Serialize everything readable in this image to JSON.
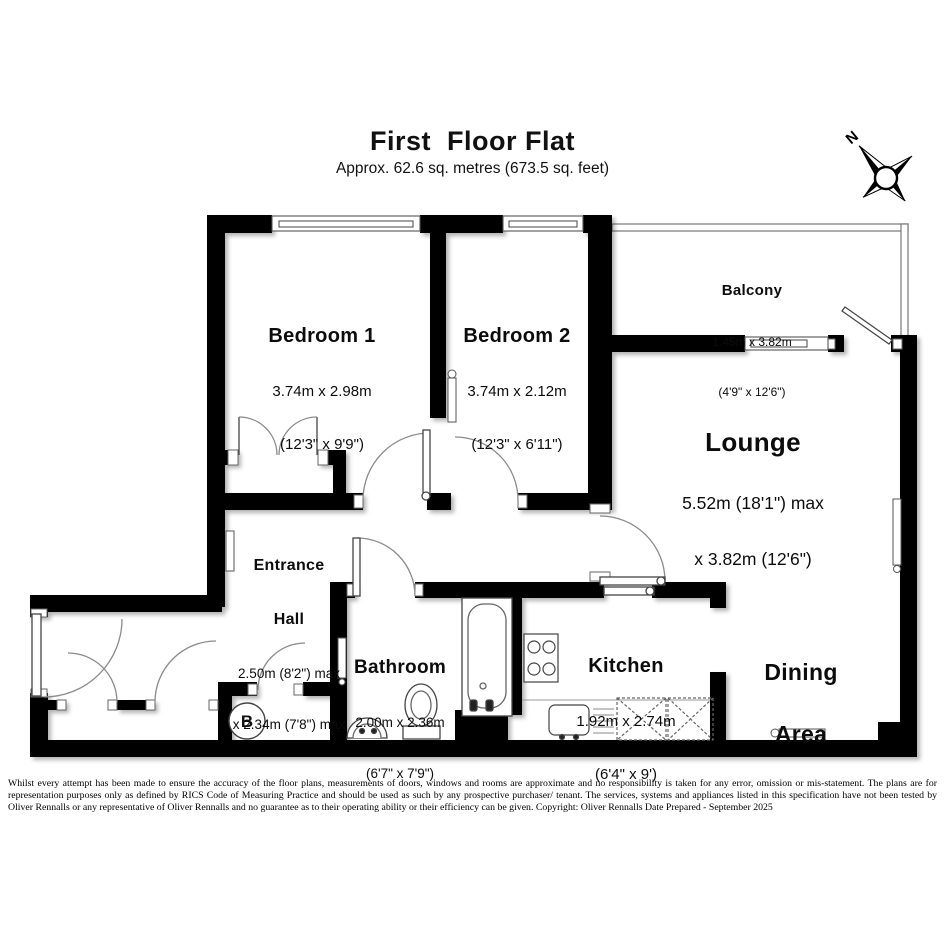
{
  "title": {
    "heading": "First  Floor Flat",
    "subtitle": "Approx. 62.6 sq. metres (673.5 sq. feet)"
  },
  "compass": {
    "north_label": "N"
  },
  "rooms": {
    "bedroom1": {
      "name": "Bedroom 1",
      "dims_metric": "3.74m x 2.98m",
      "dims_imperial": "(12'3\" x 9'9\")"
    },
    "bedroom2": {
      "name": "Bedroom 2",
      "dims_metric": "3.74m x 2.12m",
      "dims_imperial": "(12'3\" x 6'11\")"
    },
    "balcony": {
      "name": "Balcony",
      "dims_metric": "1.45m x 3.82m",
      "dims_imperial": "(4'9\" x 12'6\")"
    },
    "lounge": {
      "name": "Lounge",
      "dims_line1": "5.52m (18'1\") max",
      "dims_line2": "x 3.82m (12'6\")"
    },
    "entrance_hall": {
      "name_line1": "Entrance",
      "name_line2": "Hall",
      "dims_line1": "2.50m (8'2\") max",
      "dims_line2": "x 2.34m (7'8\") max"
    },
    "bathroom": {
      "name": "Bathroom",
      "dims_metric": "2.00m x 2.36m",
      "dims_imperial": "(6'7\" x 7'9\")"
    },
    "kitchen": {
      "name": "Kitchen",
      "dims_metric": "1.92m x 2.74m",
      "dims_imperial": "(6'4\" x 9')"
    },
    "dining": {
      "name_line1": "Dining",
      "name_line2": "Area"
    },
    "boiler": {
      "label": "B"
    }
  },
  "footer": {
    "disclaimer": "Whilst every attempt has been made to ensure the accuracy of the floor plans, measurements of doors, windows and rooms are approximate and no responsibility is taken for any error, omission or mis-statement. The plans are for representation purposes only as defined by RICS Code of Measuring Practice and should be used as such by any prospective purchaser/ tenant. The services, systems and appliances listed in this specification have not been tested by Oliver Rennalls or any representative of Oliver Rennalls and no guarantee as to their operating ability or their efficiency can be given. Copyright: Oliver Rennalls Date Prepared - September 2025"
  },
  "colors": {
    "wall": "#000000",
    "floor": "#ffffff",
    "outline": "#555555"
  }
}
